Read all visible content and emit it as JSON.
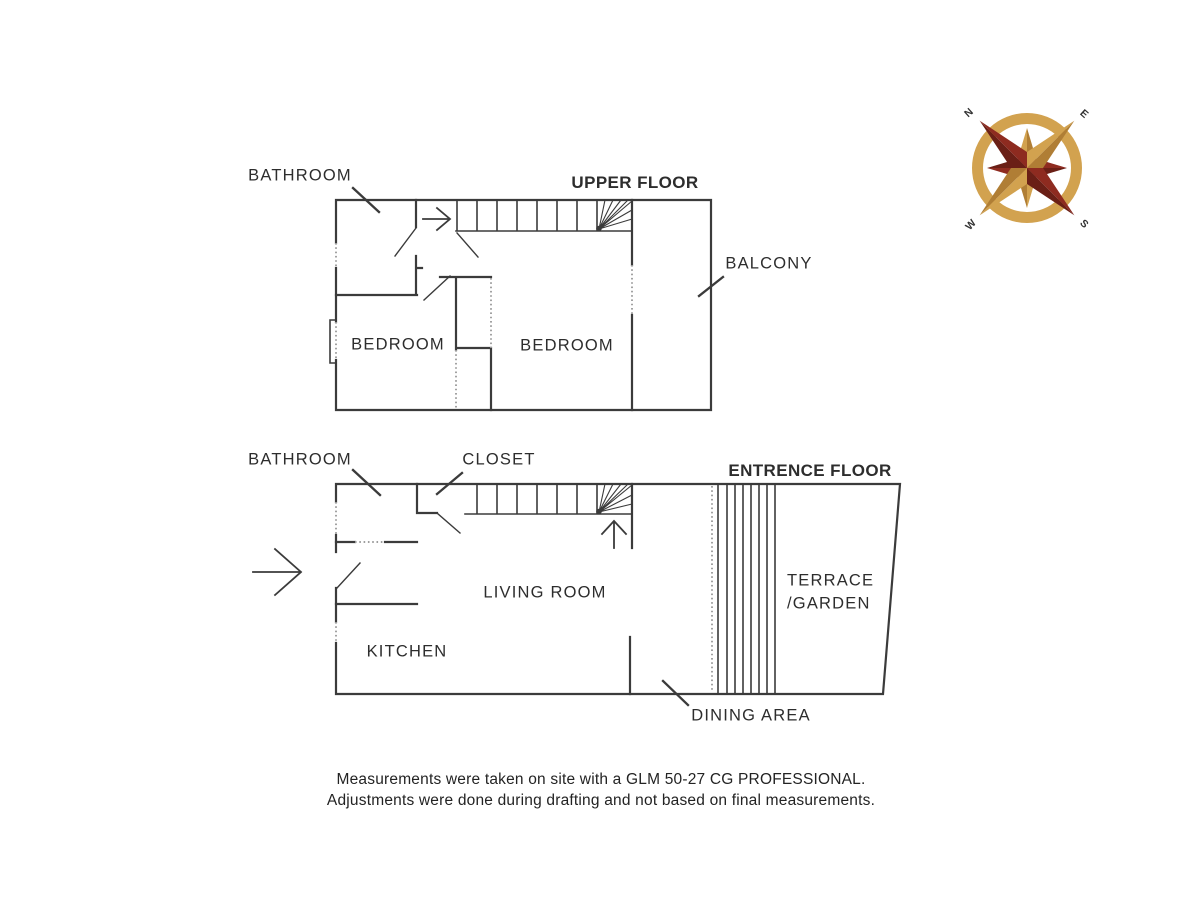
{
  "diagram": {
    "type": "floor_plan",
    "upper_floor": {
      "title": "UPPER FLOOR",
      "labels": {
        "bathroom": "BATHROOM",
        "bedroom_left": "BEDROOM",
        "bedroom_right": "BEDROOM",
        "balcony": "BALCONY"
      }
    },
    "entrance_floor": {
      "title": "ENTRENCE FLOOR",
      "labels": {
        "bathroom": "BATHROOM",
        "closet": "CLOSET",
        "living_room": "LIVING ROOM",
        "kitchen": "KITCHEN",
        "dining_area": "DINING AREA",
        "terrace_line1": "TERRACE",
        "terrace_line2": "/GARDEN"
      }
    },
    "compass": {
      "north": "N",
      "east": "E",
      "west": "W",
      "south": "S",
      "gold": "#D2A24F",
      "maroon": "#8E2B20"
    },
    "footer": {
      "line1": "Measurements were taken on site with a GLM 50-27 CG PROFESSIONAL.",
      "line2": "Adjustments were done during drafting and not based on final measurements."
    },
    "colors": {
      "wall_line": "#3b3b3b",
      "dotted_line": "#9e9e9e",
      "text": "#2d2d2d"
    }
  }
}
